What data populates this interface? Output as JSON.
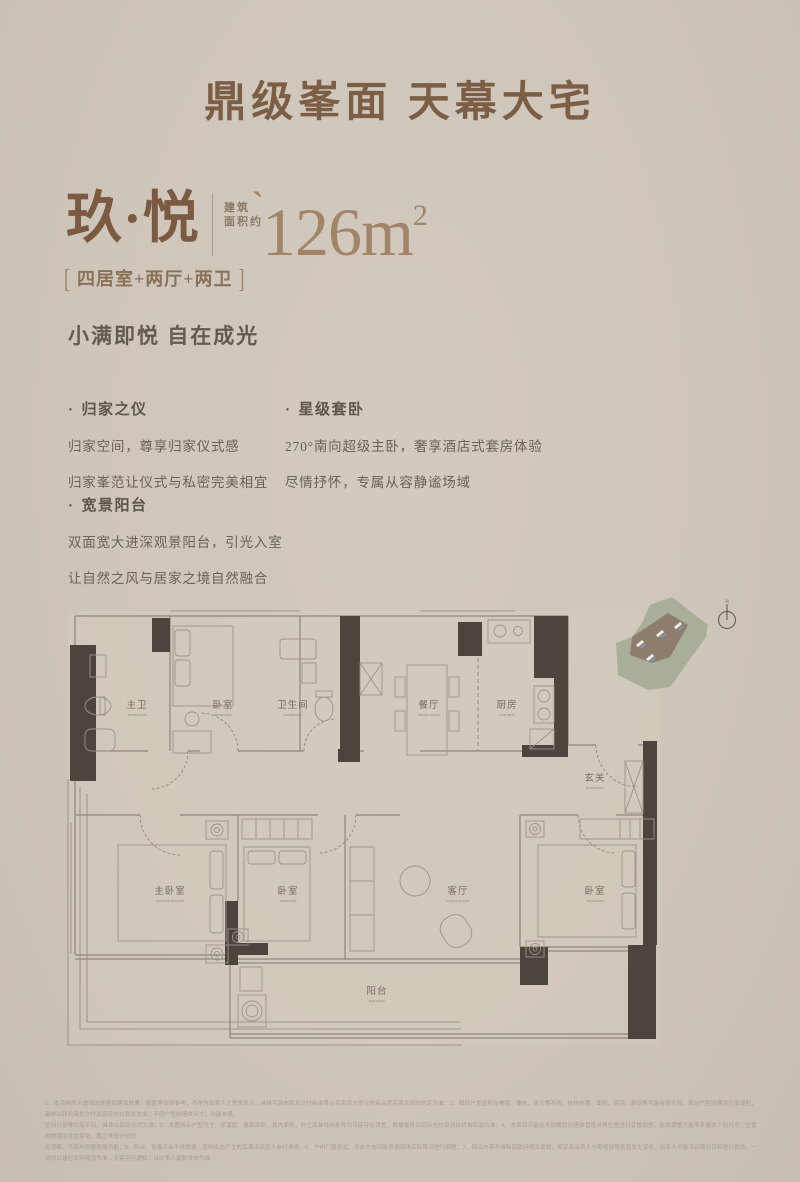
{
  "header": {
    "title": "鼎级峯面 天幕大宅"
  },
  "product": {
    "name": "玖·悦",
    "area_prefix_line1": "建筑",
    "area_prefix_line2": "面积约",
    "tick": "`",
    "area_value": "126",
    "area_unit": "m",
    "area_sup": "2",
    "bracket_left": "[",
    "bracket_right": "]",
    "spec": "四居室+两厅+两卫",
    "slogan": "小满即悦 自在成光"
  },
  "ui": {
    "bullet": "·"
  },
  "features": [
    {
      "title": "归家之仪",
      "lines": [
        "归家空间，尊享归家仪式感",
        "归家峯范让仪式与私密完美相宜"
      ]
    },
    {
      "title": "星级套卧",
      "lines": [
        "270°南向超级主卧，奢享酒店式套房体验",
        "尽情抒怀，专属从容静谧场域"
      ]
    },
    {
      "title": "宽景阳台",
      "lines": [
        "双面宽大进深观景阳台，引光入室",
        "让自然之风与居家之境自然融合"
      ]
    }
  ],
  "floorplan": {
    "rooms": [
      {
        "name": "主卫",
        "en": "BATHROOM"
      },
      {
        "name": "卧室",
        "en": "BEDROOM"
      },
      {
        "name": "卫生间",
        "en": "BATHROOM"
      },
      {
        "name": "餐厅",
        "en": "DINING ROOM"
      },
      {
        "name": "厨房",
        "en": "KITCHEN"
      },
      {
        "name": "玄关",
        "en": "ENTRANCE"
      },
      {
        "name": "主卧室",
        "en": "MASTER BED RM"
      },
      {
        "name": "卧室",
        "en": "BEDROOM"
      },
      {
        "name": "客厅",
        "en": "LIVING ROOM"
      },
      {
        "name": "卧室",
        "en": "BEDROOM"
      },
      {
        "name": "阳台",
        "en": "BALCONY"
      }
    ],
    "compass_label": "N"
  },
  "colors": {
    "background": "#cfc6bb",
    "title_brown": "#7c5e45",
    "bronze": "#a28467",
    "wall_dark": "#4c453d",
    "wall_thin": "#8f867b",
    "site_green": "#a8ae98",
    "site_brown": "#8e7c6c"
  },
  "disclaimer": {
    "lines": [
      "1、本资料所示虚拟的数据及建筑效果、配置等仅供参考，不作为出卖人之意思表示，具体平面布局及交付标准等以买卖双方签订的商品房买卖合同的约定为准；2、相同户型因所在楼层、楼栋、单元等不同，结构布置、面积、层高、朝向等可能有所不同，部分户型因建筑立面造型，最终以政府审批文件及实际交付现状为准；不同户型的墙体尺寸、功能布局、",
      "空间分割等均有不同，具体以实际交付为准；3、本图所示户型尺寸、保温层、建筑面积、套内面积，外立面装饰线条等均可能存在误差，数据最终以实际交付及测绘机构实测为准；4、本项目可能在不同楼层对墙体管道井等位置进行变橙调整，此类调整可能带来墙体个别尺寸、位置的微调及发生变化，属正常设计分优",
      "化范畴，不影响房屋使用功能；5、阳台、设备平台不得改造，否则由此产生的后果由买受人自行承担；6、户内门窗形式、开启方向可能根据现场实际情况进行调整；7、相关内容不排除因政府相关规划、规定及出卖人分期规划等原因发生变化，出卖人可能不定期对资料进行修改，一切均以届时实际情况为准，无需另行通知，以出卖人最新发布为准。"
    ]
  }
}
